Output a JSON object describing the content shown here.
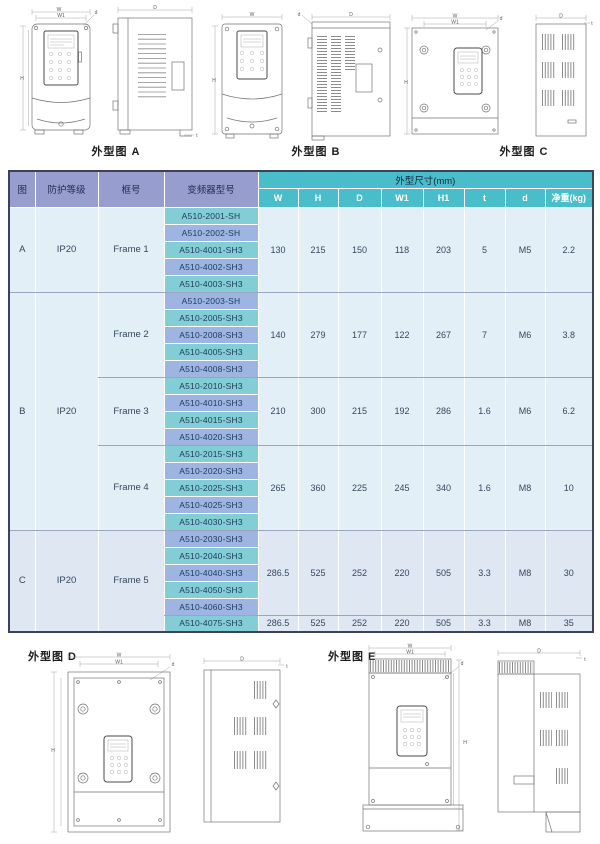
{
  "figures": {
    "top": [
      {
        "label": "外型图 A"
      },
      {
        "label": "外型图 B"
      },
      {
        "label": "外型图 C"
      }
    ],
    "bottom": [
      {
        "label": "外型图 D"
      },
      {
        "label": "外型图 E"
      }
    ]
  },
  "dims": {
    "w": "W",
    "w1": "W1",
    "h": "H",
    "h1": "H1",
    "depth": "D",
    "t": "t",
    "d": "d"
  },
  "table": {
    "header": {
      "fig": "图",
      "protection": "防护等级",
      "frame": "框号",
      "model": "变频器型号",
      "dims_group": "外型尺寸(mm)",
      "cols": [
        "W",
        "H",
        "D",
        "W1",
        "H1",
        "t",
        "d",
        "净重(kg)"
      ],
      "col_names": [
        "w",
        "h",
        "d-depth",
        "w1",
        "h1",
        "t",
        "d-hole",
        "net-weight"
      ]
    },
    "sections": [
      {
        "fig": "A",
        "protection": "IP20",
        "groups": [
          {
            "frame": "Frame 1",
            "models": [
              "A510-2001-SH",
              "A510-2002-SH",
              "A510-4001-SH3",
              "A510-4002-SH3",
              "A510-4003-SH3"
            ],
            "values": [
              "130",
              "215",
              "150",
              "118",
              "203",
              "5",
              "M5",
              "2.2"
            ]
          }
        ]
      },
      {
        "fig": "B",
        "protection": "IP20",
        "groups": [
          {
            "frame": "Frame 2",
            "models": [
              "A510-2003-SH",
              "A510-2005-SH3",
              "A510-2008-SH3",
              "A510-4005-SH3",
              "A510-4008-SH3"
            ],
            "values": [
              "140",
              "279",
              "177",
              "122",
              "267",
              "7",
              "M6",
              "3.8"
            ]
          },
          {
            "frame": "Frame 3",
            "models": [
              "A510-2010-SH3",
              "A510-4010-SH3",
              "A510-4015-SH3",
              "A510-4020-SH3"
            ],
            "values": [
              "210",
              "300",
              "215",
              "192",
              "286",
              "1.6",
              "M6",
              "6.2"
            ]
          },
          {
            "frame": "Frame 4",
            "models": [
              "A510-2015-SH3",
              "A510-2020-SH3",
              "A510-2025-SH3",
              "A510-4025-SH3",
              "A510-4030-SH3"
            ],
            "values": [
              "265",
              "360",
              "225",
              "245",
              "340",
              "1.6",
              "M8",
              "10"
            ]
          }
        ]
      },
      {
        "fig": "C",
        "protection": "IP20",
        "groups": [
          {
            "frame": "Frame 5",
            "models": [
              "A510-2030-SH3",
              "A510-2040-SH3",
              "A510-4040-SH3",
              "A510-4050-SH3",
              "A510-4060-SH3"
            ],
            "values": [
              "286.5",
              "525",
              "252",
              "220",
              "505",
              "3.3",
              "M8",
              "30"
            ],
            "extra_row": {
              "model": "A510-4075-SH3",
              "values": [
                "286.5",
                "525",
                "252",
                "220",
                "505",
                "3.3",
                "M8",
                "35"
              ]
            }
          }
        ]
      }
    ]
  },
  "colors": {
    "table_outer_border": "#3c415f",
    "header_left_bg": "#979ecd",
    "header_dims_bg": "#49bdca",
    "header_dims_text": "#ffffff",
    "model_teal": "#82ced4",
    "model_blue": "#9eb5e1",
    "body_bg_ab": "#e2eff6",
    "body_bg_c": "#dee7f2",
    "separator": "#9aa6bf"
  }
}
